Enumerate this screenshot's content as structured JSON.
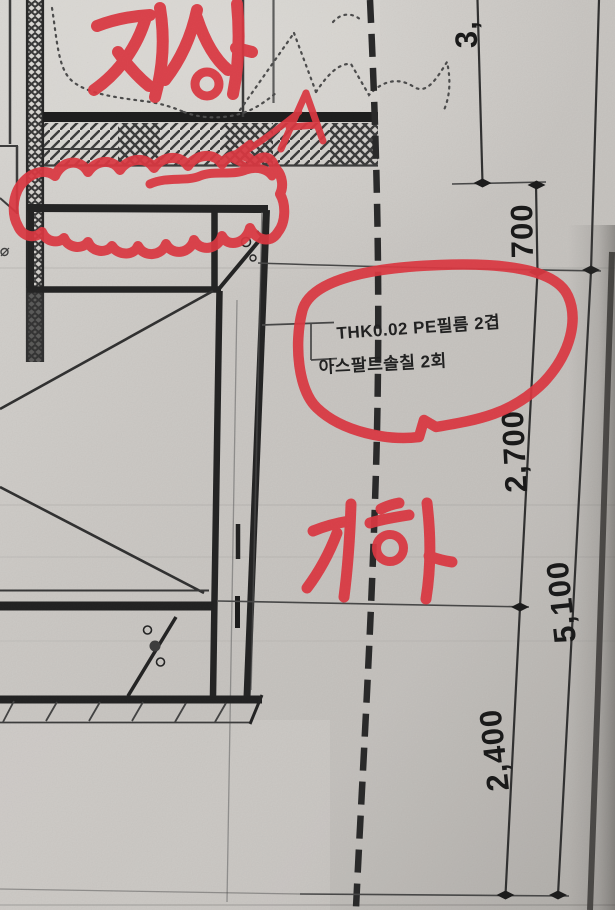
{
  "red_annotations": {
    "above_ground_label": "지상",
    "below_ground_label": "지하",
    "detail_letter": "A"
  },
  "material_callout": {
    "line1": "THK0.02 PE필름 2겹",
    "line2": "아스팔트솔칠 2회"
  },
  "dimensions": {
    "top_partial": "3,",
    "d700": "700",
    "d2700": "2,700",
    "d5100": "5,100",
    "d2400": "2,400"
  },
  "colors": {
    "marker_red": "#e03a44",
    "ink": "#2a2a2a",
    "paper": "#cdcac6"
  }
}
